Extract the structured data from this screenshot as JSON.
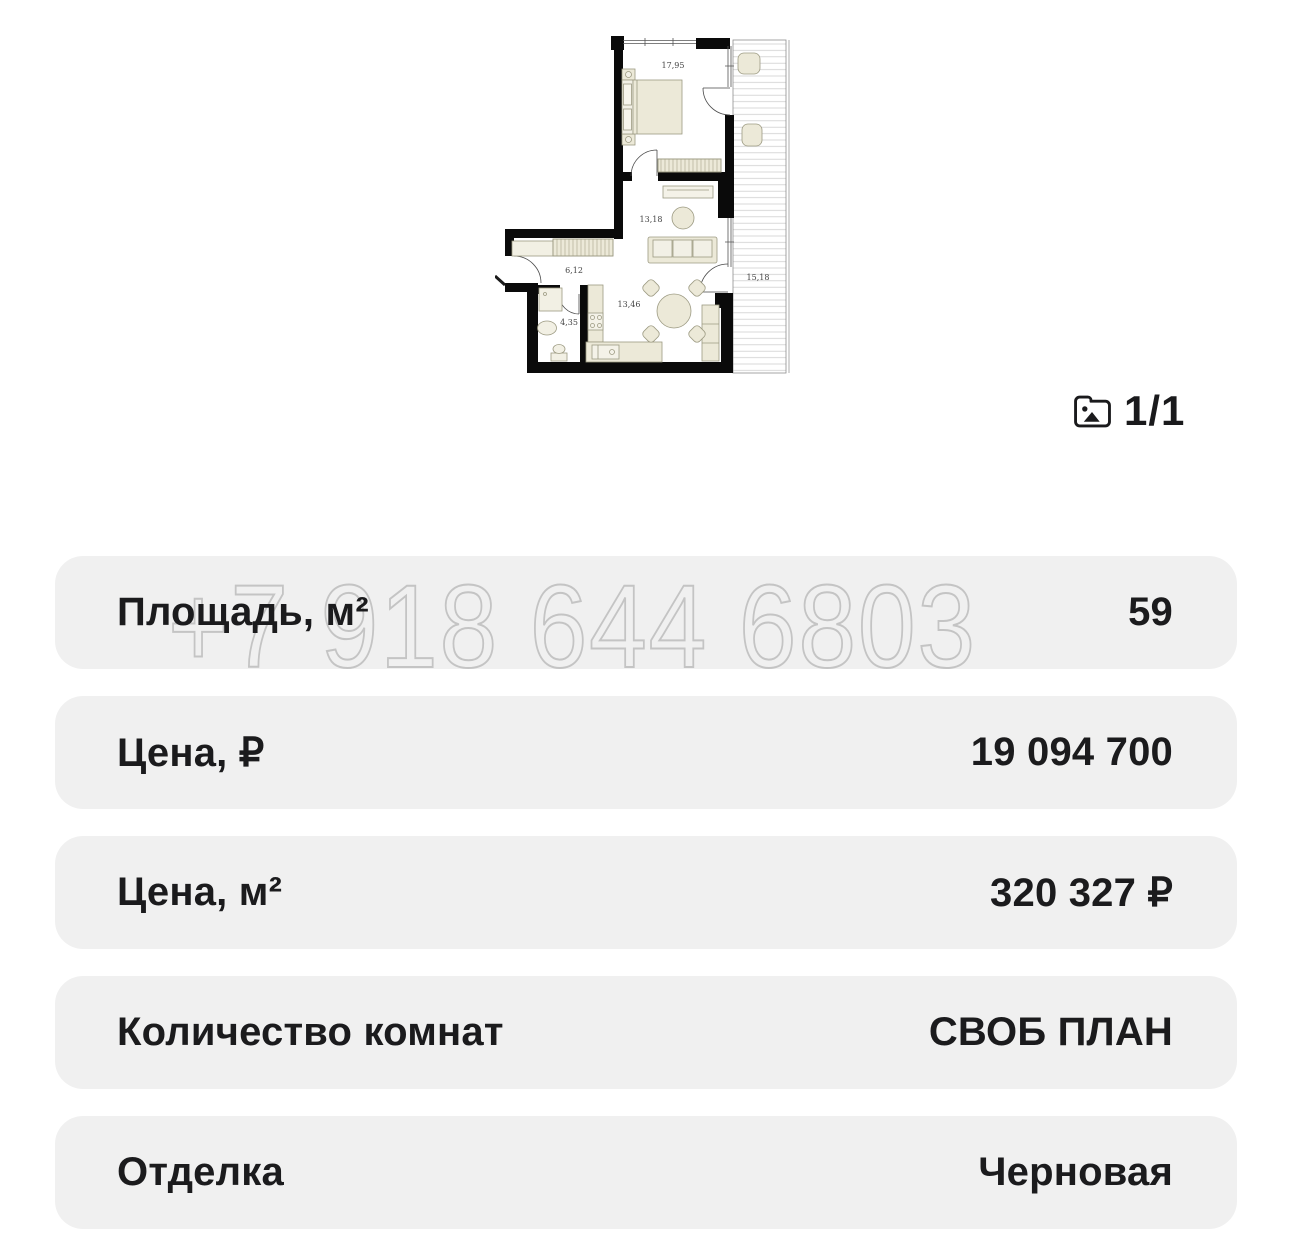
{
  "gallery": {
    "counter": "1/1",
    "icon": "photo-icon"
  },
  "floor_plan": {
    "rooms": {
      "bedroom": "17,95",
      "living": "13,18",
      "hall": "6,12",
      "bathroom": "4,35",
      "kitchen": "13,46",
      "balcony": "15,18"
    }
  },
  "watermark": {
    "text": "+7 918 644 6803"
  },
  "details": {
    "rows": [
      {
        "label": "Площадь, м²",
        "value": "59"
      },
      {
        "label": "Цена, ₽",
        "value": "19 094 700"
      },
      {
        "label": "Цена, м²",
        "value": "320 327 ₽"
      },
      {
        "label": "Количество комнат",
        "value": "СВОБ ПЛАН"
      },
      {
        "label": "Отделка",
        "value": "Черновая"
      }
    ]
  },
  "colors": {
    "row_background": "#f0f0f0",
    "text": "#1b1b1d",
    "watermark_stroke": "#c4c4c4",
    "wall": "#0a0a0a",
    "furniture_fill": "#ece9d8",
    "furniture_stroke": "#9c9a82"
  }
}
